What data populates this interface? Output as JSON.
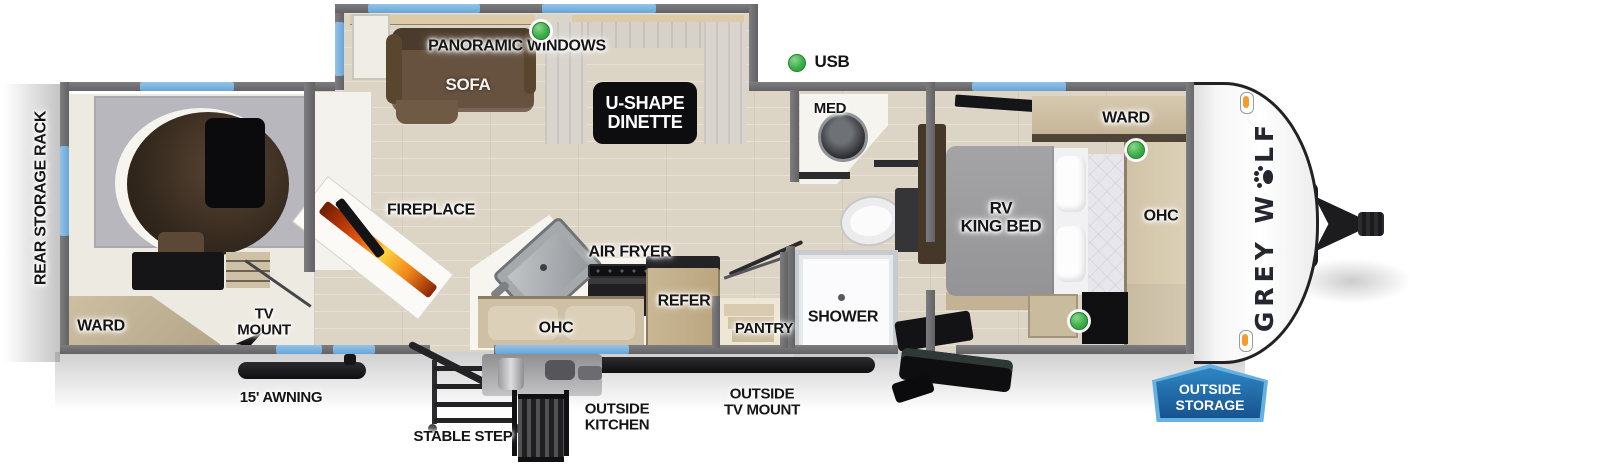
{
  "legend": {
    "usb": "USB"
  },
  "labels": {
    "rear_storage_rack": "REAR STORAGE RACK",
    "panoramic_windows": "PANORAMIC WINDOWS",
    "sofa": "SOFA",
    "dinette": [
      "U-SHAPE",
      "DINETTE"
    ],
    "fireplace": "FIREPLACE",
    "air_fryer": "AIR FRYER",
    "ohc_kitchen": "OHC",
    "refer": "REFER",
    "pantry": "PANTRY",
    "med": "MED",
    "shower": "SHOWER",
    "ward_bedroom": "WARD",
    "rv_king_bed": [
      "RV",
      "KING BED"
    ],
    "ohc_bedroom": "OHC",
    "ward_rear": "WARD",
    "tv_mount": [
      "TV",
      "MOUNT"
    ],
    "awning": "15' AWNING",
    "stable_step": "STABLE STEP",
    "outside_kitchen": [
      "OUTSIDE",
      "KITCHEN"
    ],
    "outside_tv_mount": [
      "OUTSIDE",
      "TV MOUNT"
    ],
    "outside_storage": [
      "OUTSIDE",
      "STORAGE"
    ]
  },
  "brand": {
    "logo_prefix": "GREY W",
    "logo_suffix": "LF"
  },
  "colors": {
    "wall_gray": "#6f6f71",
    "window_blue": "#7fb7e4",
    "usb_green": "#3cb04a",
    "badge_blue": "#1e6aa8",
    "badge_border_blue": "#66b1e0",
    "flame_orange": "#e85d10",
    "marker_orange": "#f59d2c"
  }
}
